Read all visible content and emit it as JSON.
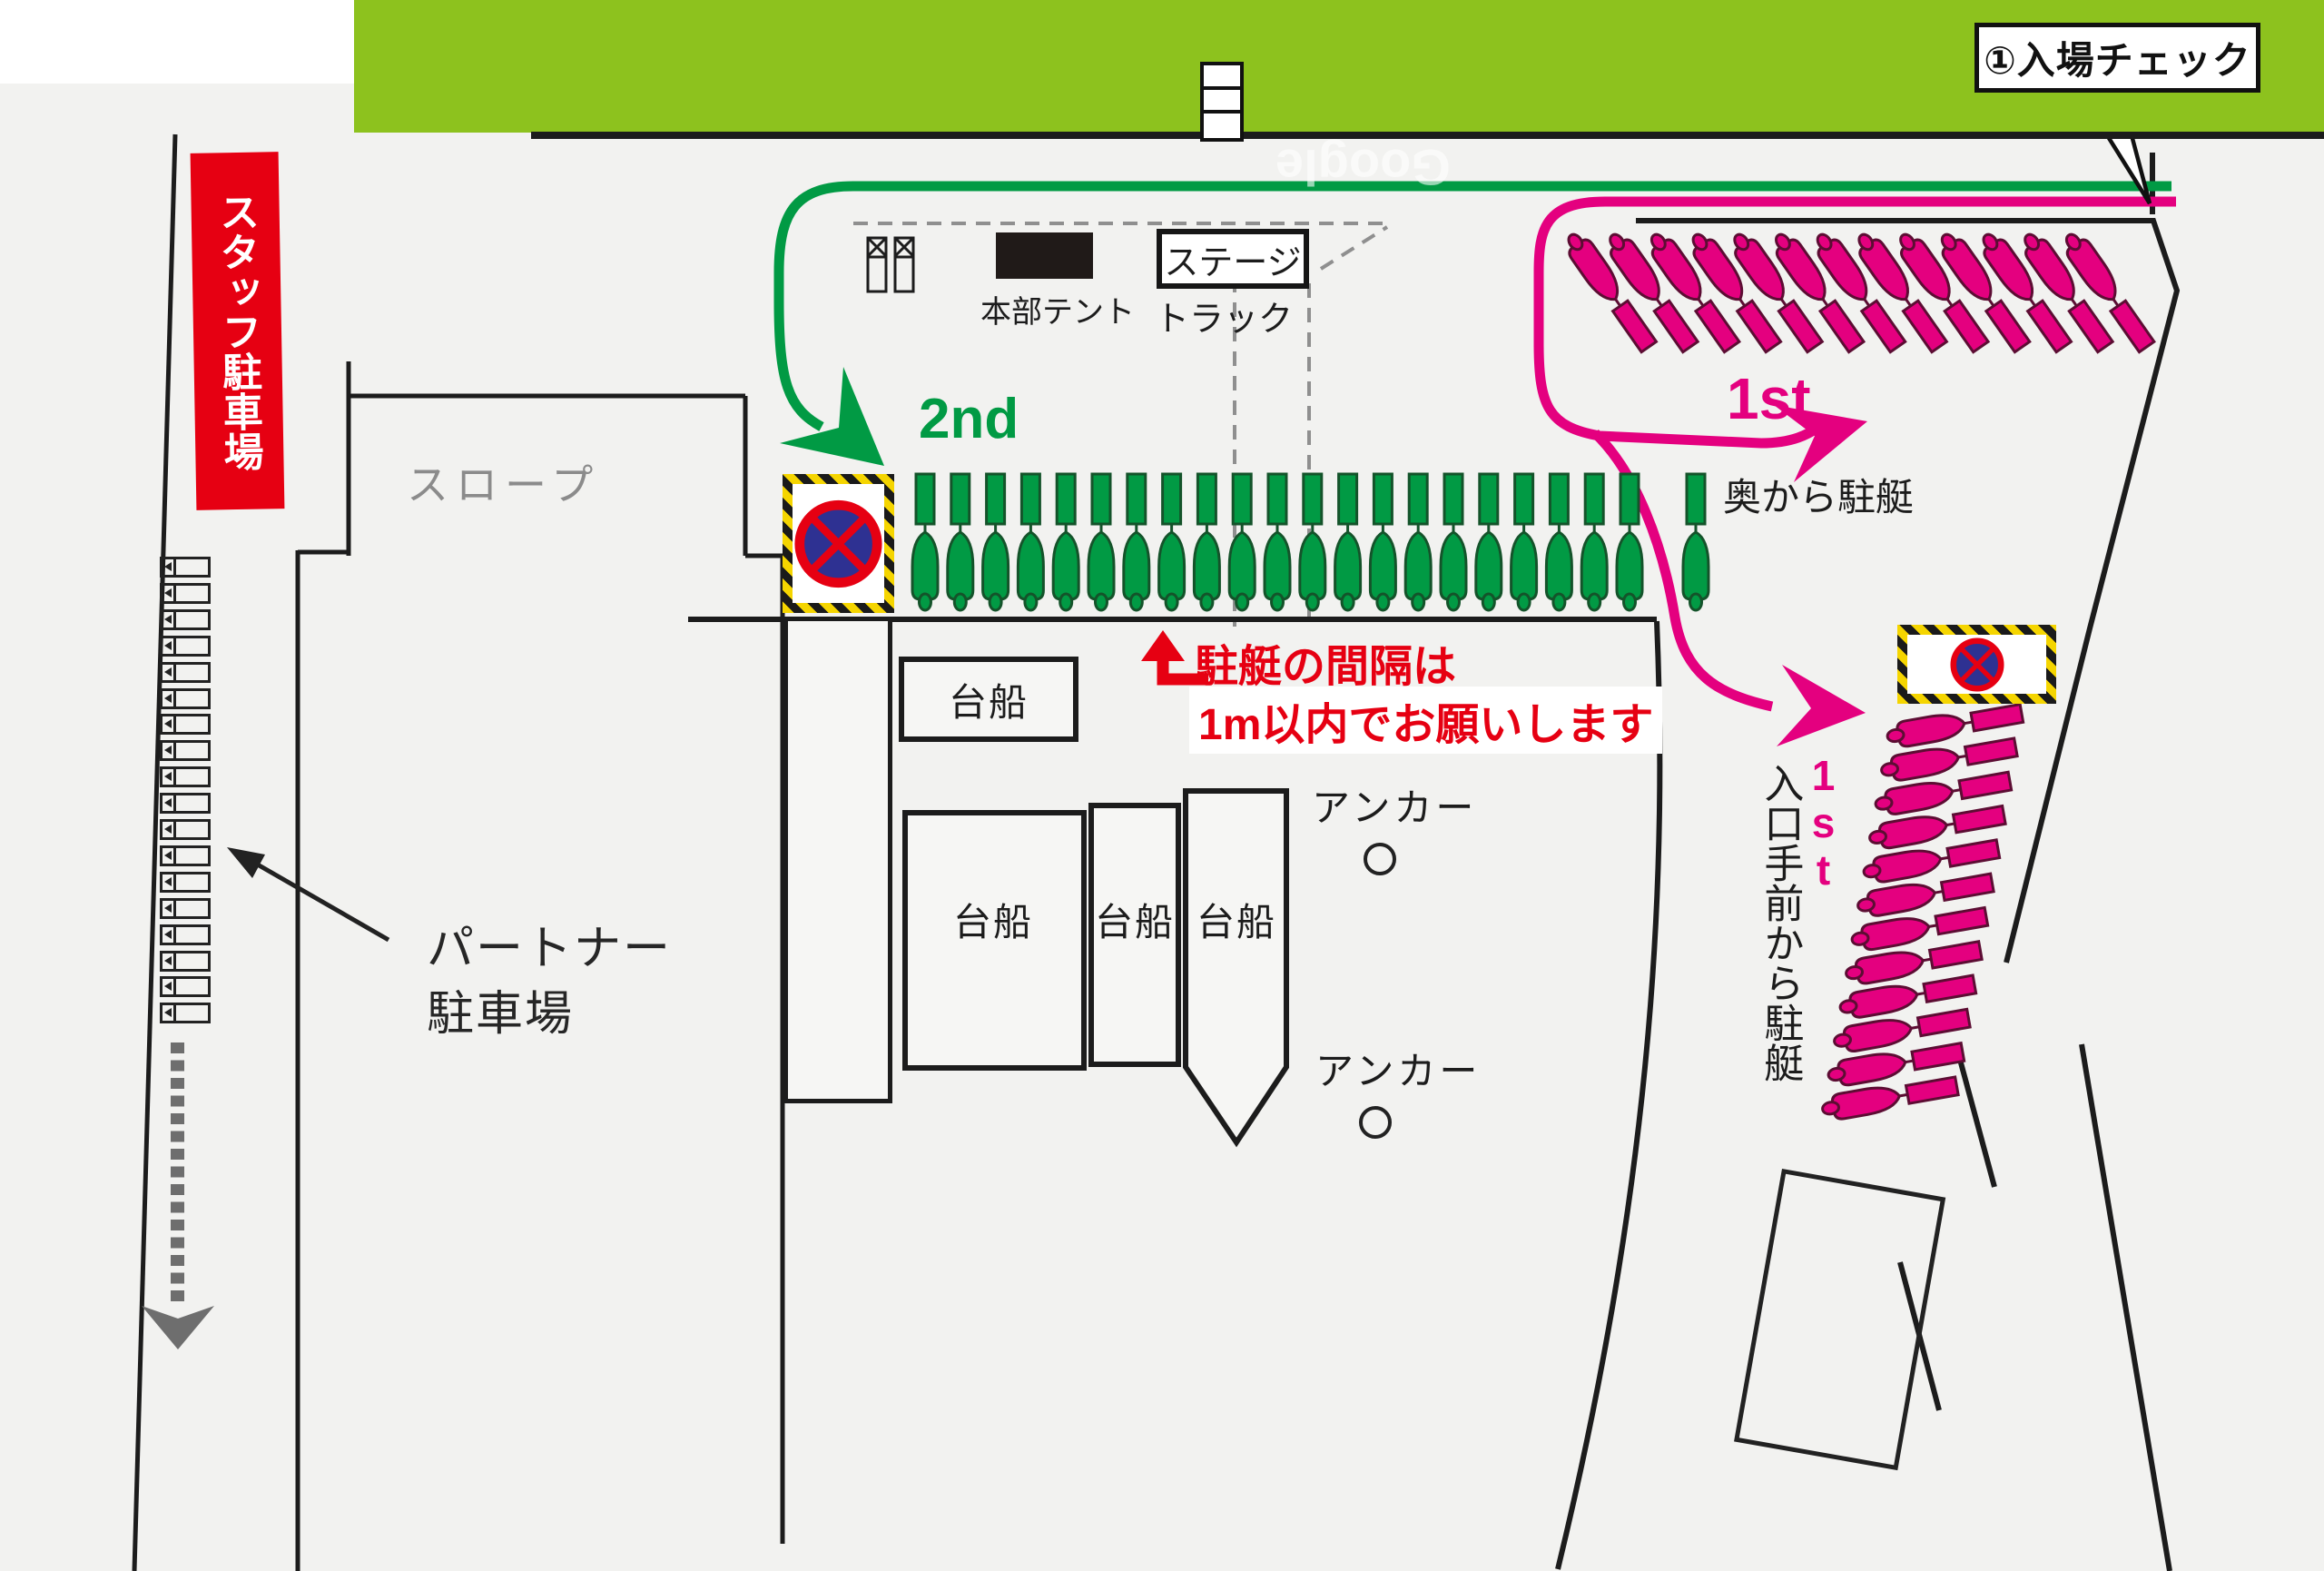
{
  "title": "会場マップ（駐艇・駐車場案内図）",
  "colors": {
    "bg": "#f2f2f0",
    "green_area": "#8dc21e",
    "route_green": "#019a44",
    "pink": "#e4007f",
    "red": "#e60012",
    "sign_blue": "#2e3192",
    "stripe_yellow": "#f5d500",
    "line_black": "#1c1c1c",
    "gray_arrow": "#6e6e6e",
    "gray_text": "#8b8b8b"
  },
  "callout": {
    "label": "①入場チェック"
  },
  "labels": {
    "staff_parking": "スタッフ駐車場",
    "slope": "スロープ",
    "hq_tent": "本部テント",
    "stage": "ステージ",
    "truck": "トラック",
    "second_route": "2nd",
    "first_route_upper": "1st",
    "park_from_back": "奥から駐艇",
    "spacing_note_line1": "駐艇の間隔は",
    "spacing_note_line2": "1m以内でお願いします",
    "anchor": "アンカー",
    "partner_line1": "パートナー",
    "partner_line2": "駐車場",
    "first_route_lower": "1st",
    "park_from_entrance": "入口手前から駐艇",
    "watermark": "Google"
  },
  "barges": [
    {
      "label": "台船"
    },
    {
      "label": "台船"
    },
    {
      "label": "台船"
    },
    {
      "label": "台船"
    }
  ],
  "boats": {
    "green_row_count": 21,
    "green_single_count": 1,
    "pink_top_row_count": 13,
    "pink_right_col_count": 12
  },
  "parking": {
    "space_count": 18
  }
}
